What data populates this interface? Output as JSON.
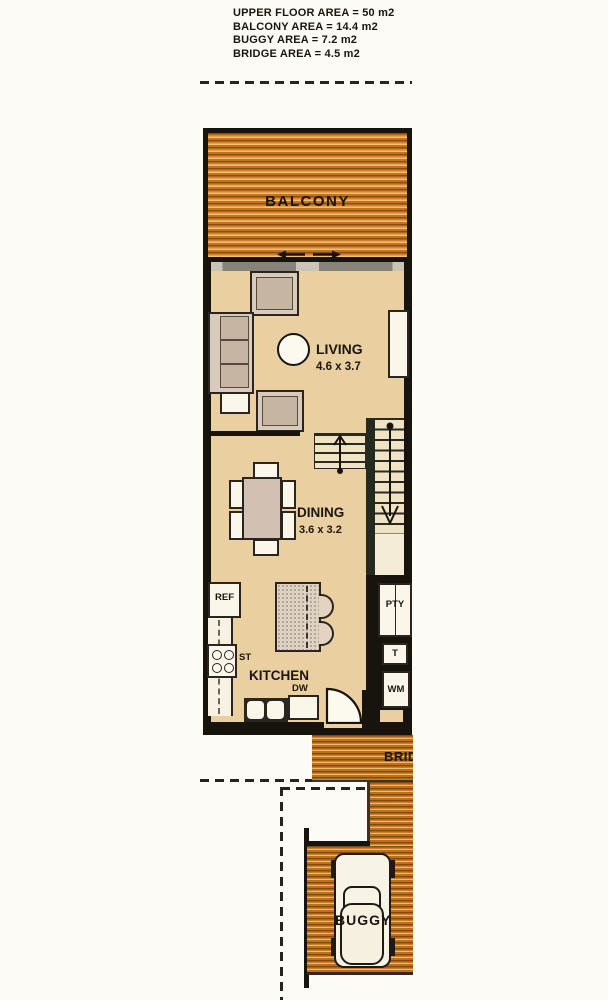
{
  "legend": {
    "lines": [
      "UPPER FLOOR AREA = 50 m2",
      "BALCONY AREA = 14.4 m2",
      "BUGGY AREA = 7.2 m2",
      "BRIDGE AREA = 4.5 m2"
    ]
  },
  "rooms": {
    "balcony": {
      "label": "BALCONY"
    },
    "living": {
      "label": "LIVING",
      "dims": "4.6 x 3.7"
    },
    "dining": {
      "label": "DINING",
      "dims": "3.6 x 3.2"
    },
    "kitchen": {
      "label": "KITCHEN"
    },
    "bridge": {
      "label": "BRIDGE"
    },
    "buggy": {
      "label": "BUGGY"
    }
  },
  "fixtures": {
    "fridge": "REF",
    "stove": "ST",
    "dishwasher": "DW",
    "pantry": "PTY",
    "toilet": "T",
    "washing_machine": "WM"
  },
  "colors": {
    "deck_wood": "#d18432",
    "floor_tan": "#ead0a0",
    "wall_black": "#17140e",
    "label_text": "#1a150e"
  }
}
